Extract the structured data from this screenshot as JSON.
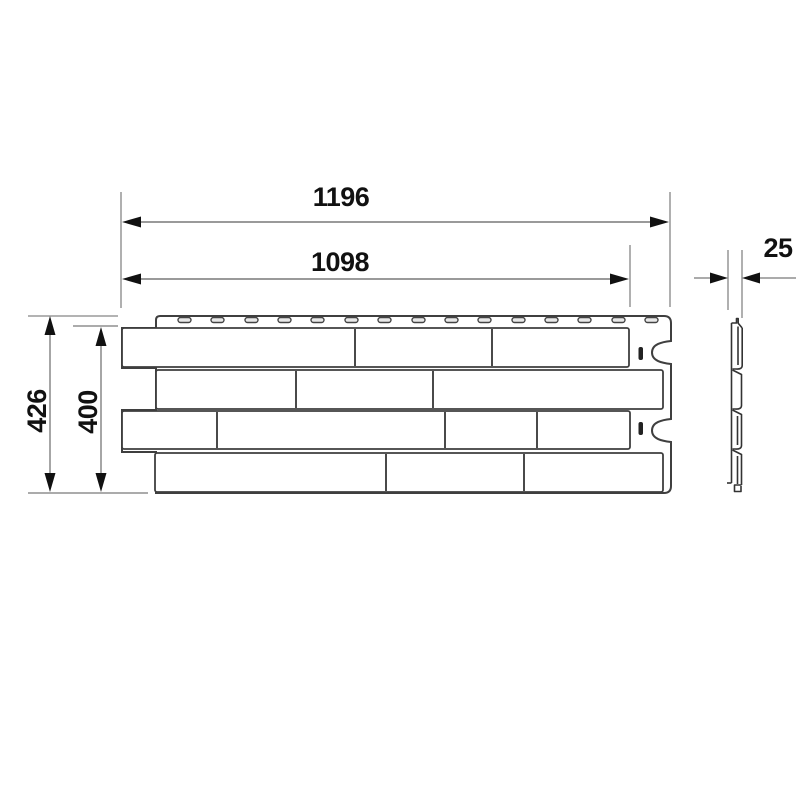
{
  "dims": {
    "overall_width": "1196",
    "working_width": "1098",
    "thickness": "25",
    "overall_height": "426",
    "working_height": "400"
  },
  "colors": {
    "background": "#ffffff",
    "panel_outline": "#3f3f3f",
    "dimension_line": "#9a9a9a",
    "extension_line": "#b3b3b3",
    "label_text": "#111111"
  },
  "front_view": {
    "brick_rows": 4,
    "bricks_per_row": [
      3,
      3,
      4,
      3
    ],
    "nail_slots": 15,
    "right_edge_notches": 2
  },
  "side_view": {
    "profile_steps": 3
  }
}
